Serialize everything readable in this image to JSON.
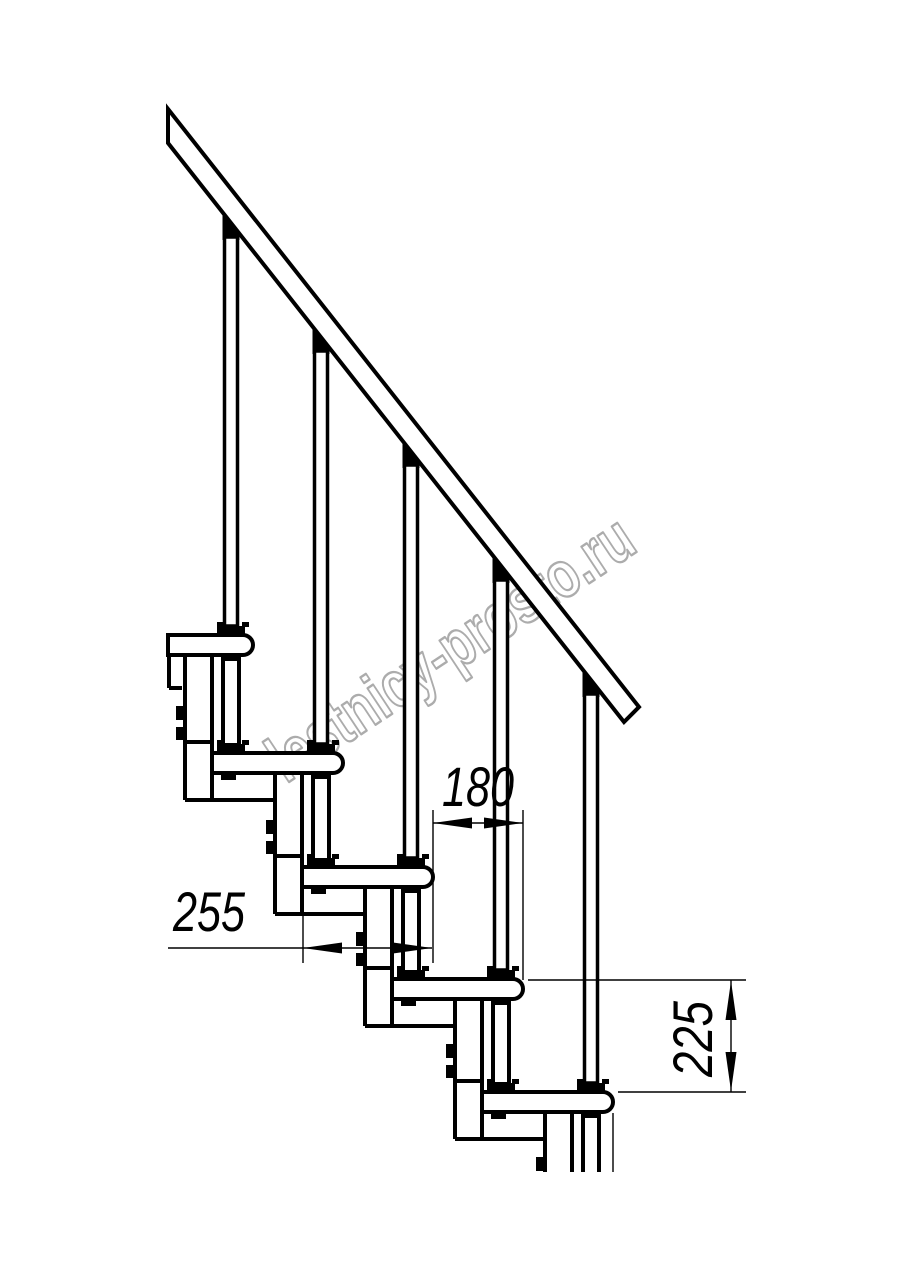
{
  "drawing": {
    "type": "modular-staircase-side-elevation",
    "dimensions": {
      "tread_depth_mm": "255",
      "going_mm": "180",
      "rise_mm": "225"
    },
    "watermark_text": "lestnicy-prosto.ru",
    "colors": {
      "line": "#000000",
      "watermark": "#a8a8a8",
      "background": "#ffffff"
    }
  }
}
